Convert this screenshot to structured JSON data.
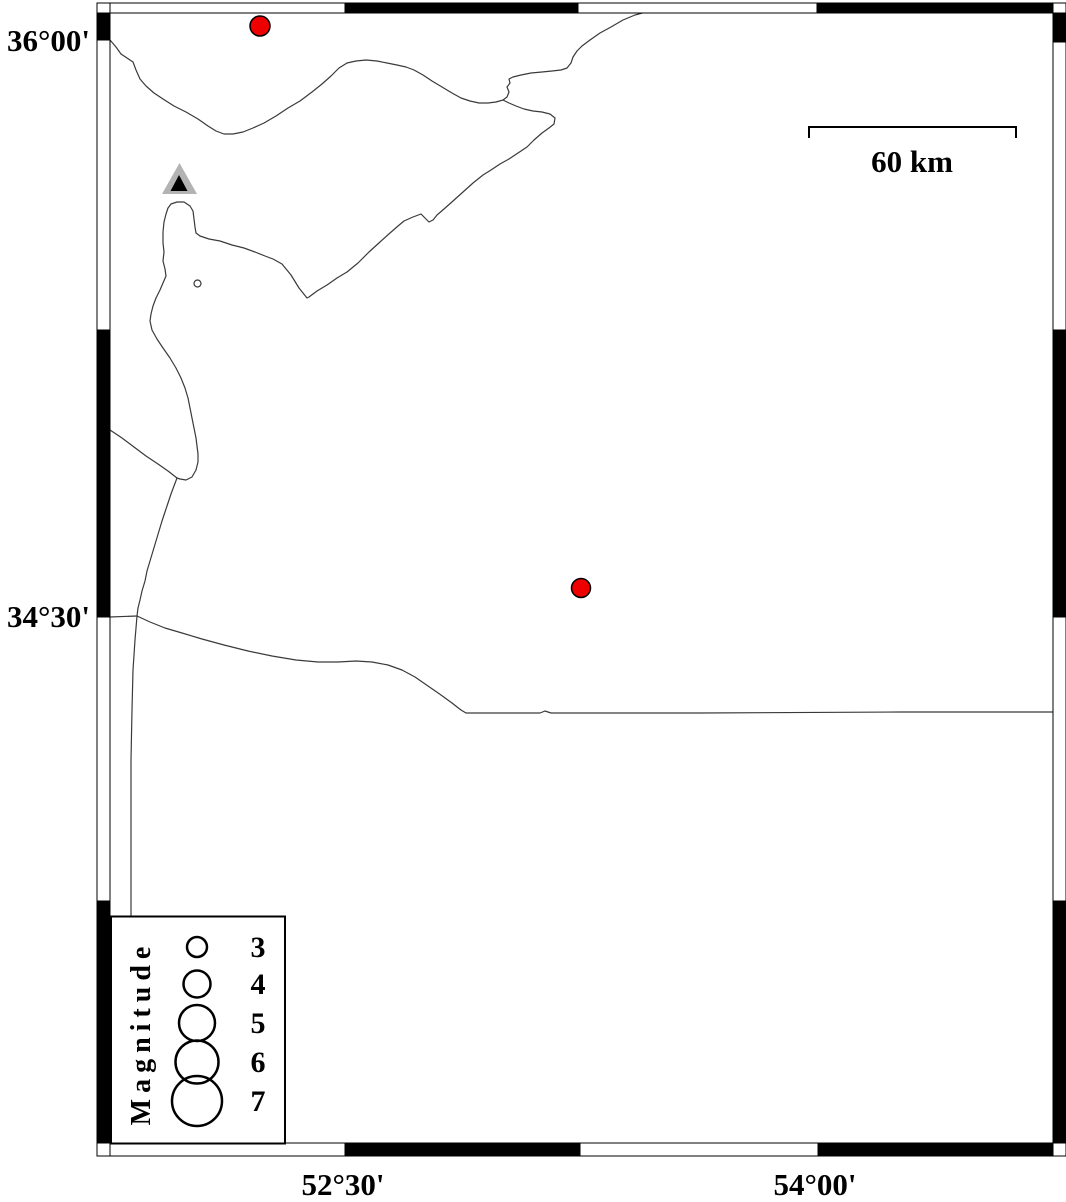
{
  "map": {
    "description": "Seismicity map with fancy alternating black/white frame",
    "background": "#ffffff"
  },
  "axis": {
    "left_labels": [
      {
        "text": "36°00'"
      },
      {
        "text": "34°30'"
      }
    ],
    "bottom_labels": [
      {
        "text": "52°30'"
      },
      {
        "text": "54°00'"
      }
    ]
  },
  "scale_bar": {
    "label": "60 km"
  },
  "legend": {
    "title": "Magnitude",
    "entries": [
      {
        "label": "3",
        "radius": 10
      },
      {
        "label": "4",
        "radius": 13.5
      },
      {
        "label": "5",
        "radius": 18
      },
      {
        "label": "6",
        "radius": 21.5
      },
      {
        "label": "7",
        "radius": 25
      }
    ]
  },
  "markers": {
    "earthquakes": [
      {
        "x": 260,
        "y": 26,
        "r": 10
      },
      {
        "x": 581,
        "y": 588,
        "r": 9.5
      }
    ],
    "station": {
      "x": 180,
      "y": 185,
      "shape": "triangle"
    }
  },
  "colors": {
    "epicenter_fill": "#ee0000",
    "triangle_outer": "#b3b3b3",
    "triangle_inner": "#000000"
  }
}
